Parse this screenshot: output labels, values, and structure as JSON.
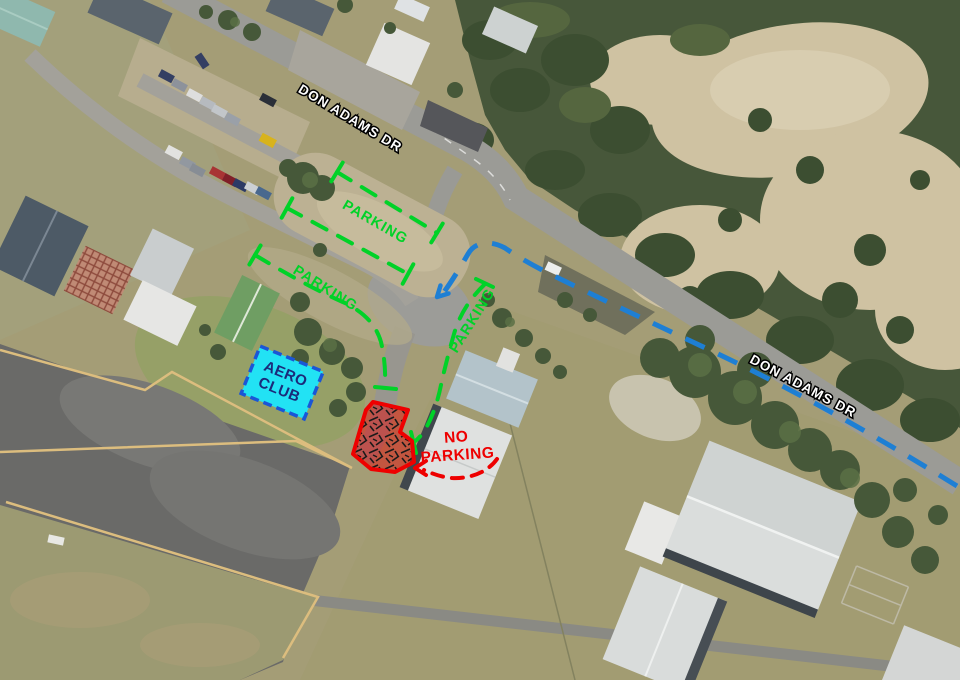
{
  "labels": {
    "road": [
      {
        "text": "DON ADAMS DR",
        "x": 348,
        "y": 122,
        "rotation_deg": 31
      },
      {
        "text": "DON ADAMS DR",
        "x": 801,
        "y": 390,
        "rotation_deg": 28
      }
    ],
    "parking": [
      {
        "text": "PARKING",
        "x": 373,
        "y": 226,
        "rotation_deg": 30
      },
      {
        "text": "PARKING",
        "x": 323,
        "y": 292,
        "rotation_deg": 32
      },
      {
        "text": "PARKING",
        "x": 476,
        "y": 323,
        "rotation_deg": -58
      }
    ],
    "no_parking": {
      "line1": "NO",
      "line2": "PARKING"
    },
    "aero_club": {
      "line1": "AERO",
      "line2": "CLUB"
    }
  },
  "colors": {
    "parking_route_green": "#00d228",
    "traffic_route_blue": "#1e7fd4",
    "no_parking_red": "#ee0000",
    "aero_club_fill_cyan": "#22e2f4",
    "aero_club_border_blue": "#1a56d6",
    "aero_club_text_navy": "#1b2a7a",
    "road_label_white": "#ffffff",
    "apron_marking_yellow": "#dcbd7e"
  }
}
